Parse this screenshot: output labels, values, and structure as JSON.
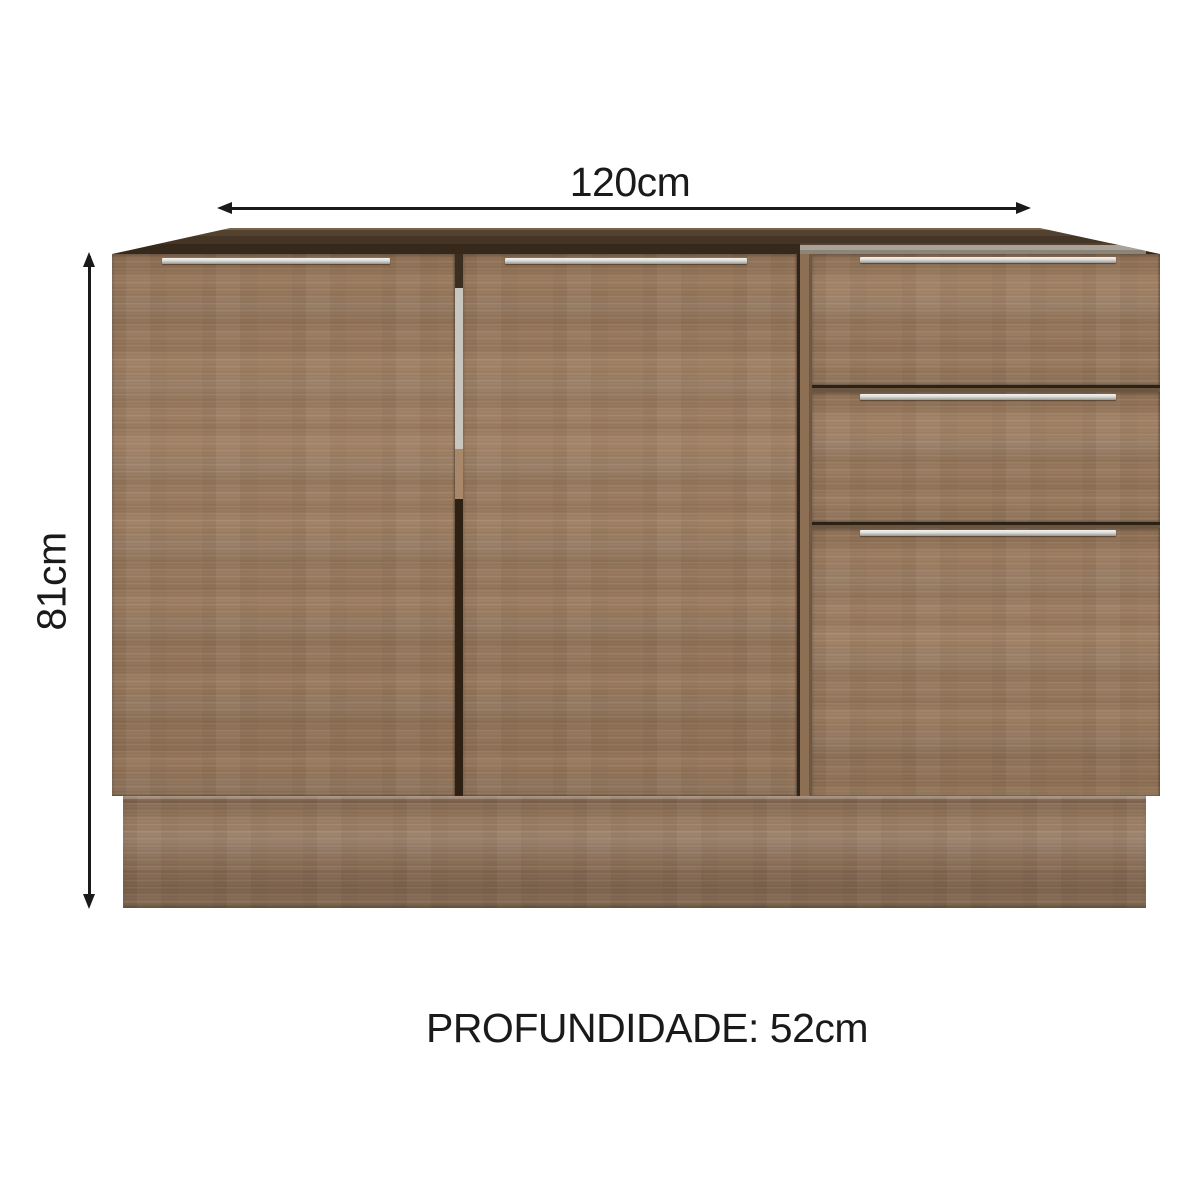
{
  "diagram": {
    "width_label": "120cm",
    "height_label": "81cm",
    "depth_label": "PROFUNDIDADE: 52cm"
  },
  "cabinet": {
    "description": "Wood kitchen base cabinet with open top, two doors on the left, three drawers on the right and a recessed plinth",
    "doors": 2,
    "drawers": 3
  },
  "colors": {
    "background": "#ffffff",
    "wood": "#9c7b5d",
    "wood_base": "#93745a",
    "top_rim_dark": "#453526",
    "drawer_top_edge_grey": "#aaa298",
    "handle_silver": "#d6d5d1",
    "dimension_line": "#1a1a1a"
  }
}
